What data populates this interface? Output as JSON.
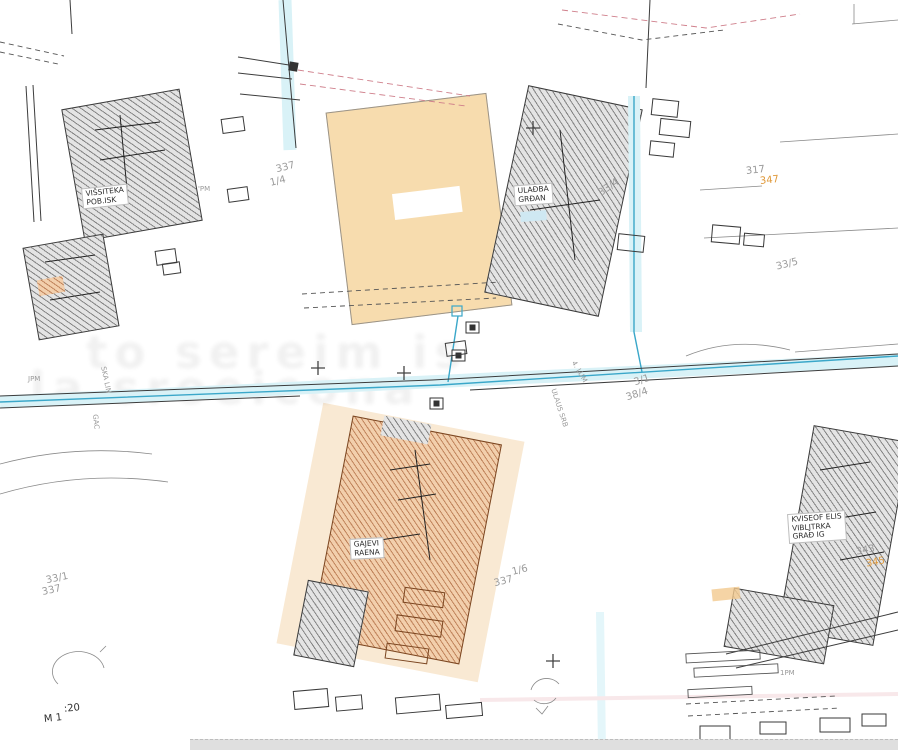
{
  "plan": {
    "scale_left": "M 1",
    "scale_right": ":20",
    "watermark": {
      "line1": "to sereim is",
      "line2": "la sroeicona"
    },
    "building_labels": {
      "topleft": {
        "line1": "VIŠSITEKA",
        "line2": "POB.ISK"
      },
      "topcenter": {
        "line1": "ULAĐBA",
        "line2": "GRĐAN"
      },
      "center": {
        "line1": "GAJEVI",
        "line2": "RAENA"
      },
      "right": {
        "line1": "KVISEOF ELIS",
        "line2": "VIBLJTRKA",
        "line3": "GRAĐ IG"
      }
    },
    "parcel_numbers": [
      {
        "text": "337"
      },
      {
        "text": "1/4"
      },
      {
        "text": "33/4"
      },
      {
        "text": "317"
      },
      {
        "text": "347"
      },
      {
        "text": "33/5"
      },
      {
        "text": "3/1"
      },
      {
        "text": "38/4"
      },
      {
        "text": "1/6"
      },
      {
        "text": "337"
      },
      {
        "text": "33/1"
      },
      {
        "text": "337"
      },
      {
        "text": "343"
      },
      {
        "text": "345"
      }
    ],
    "point_marks": [
      {
        "text": "'PM"
      },
      {
        "text": "1PM"
      },
      {
        "text": "JPM"
      }
    ],
    "street_labels": [
      {
        "text": "SKA LIN"
      },
      {
        "text": "GAC"
      },
      {
        "text": "ULAUS SRB"
      },
      {
        "text": "4. LUM"
      }
    ],
    "colors": {
      "road_cyan": "#d9f2f7",
      "utility_blue": "#3aa7c9",
      "building_fill": "#f7dcae",
      "hatch_orange": "#b4652a",
      "number_gray": "#9a9a9a",
      "number_orange": "#e09a3c"
    }
  }
}
